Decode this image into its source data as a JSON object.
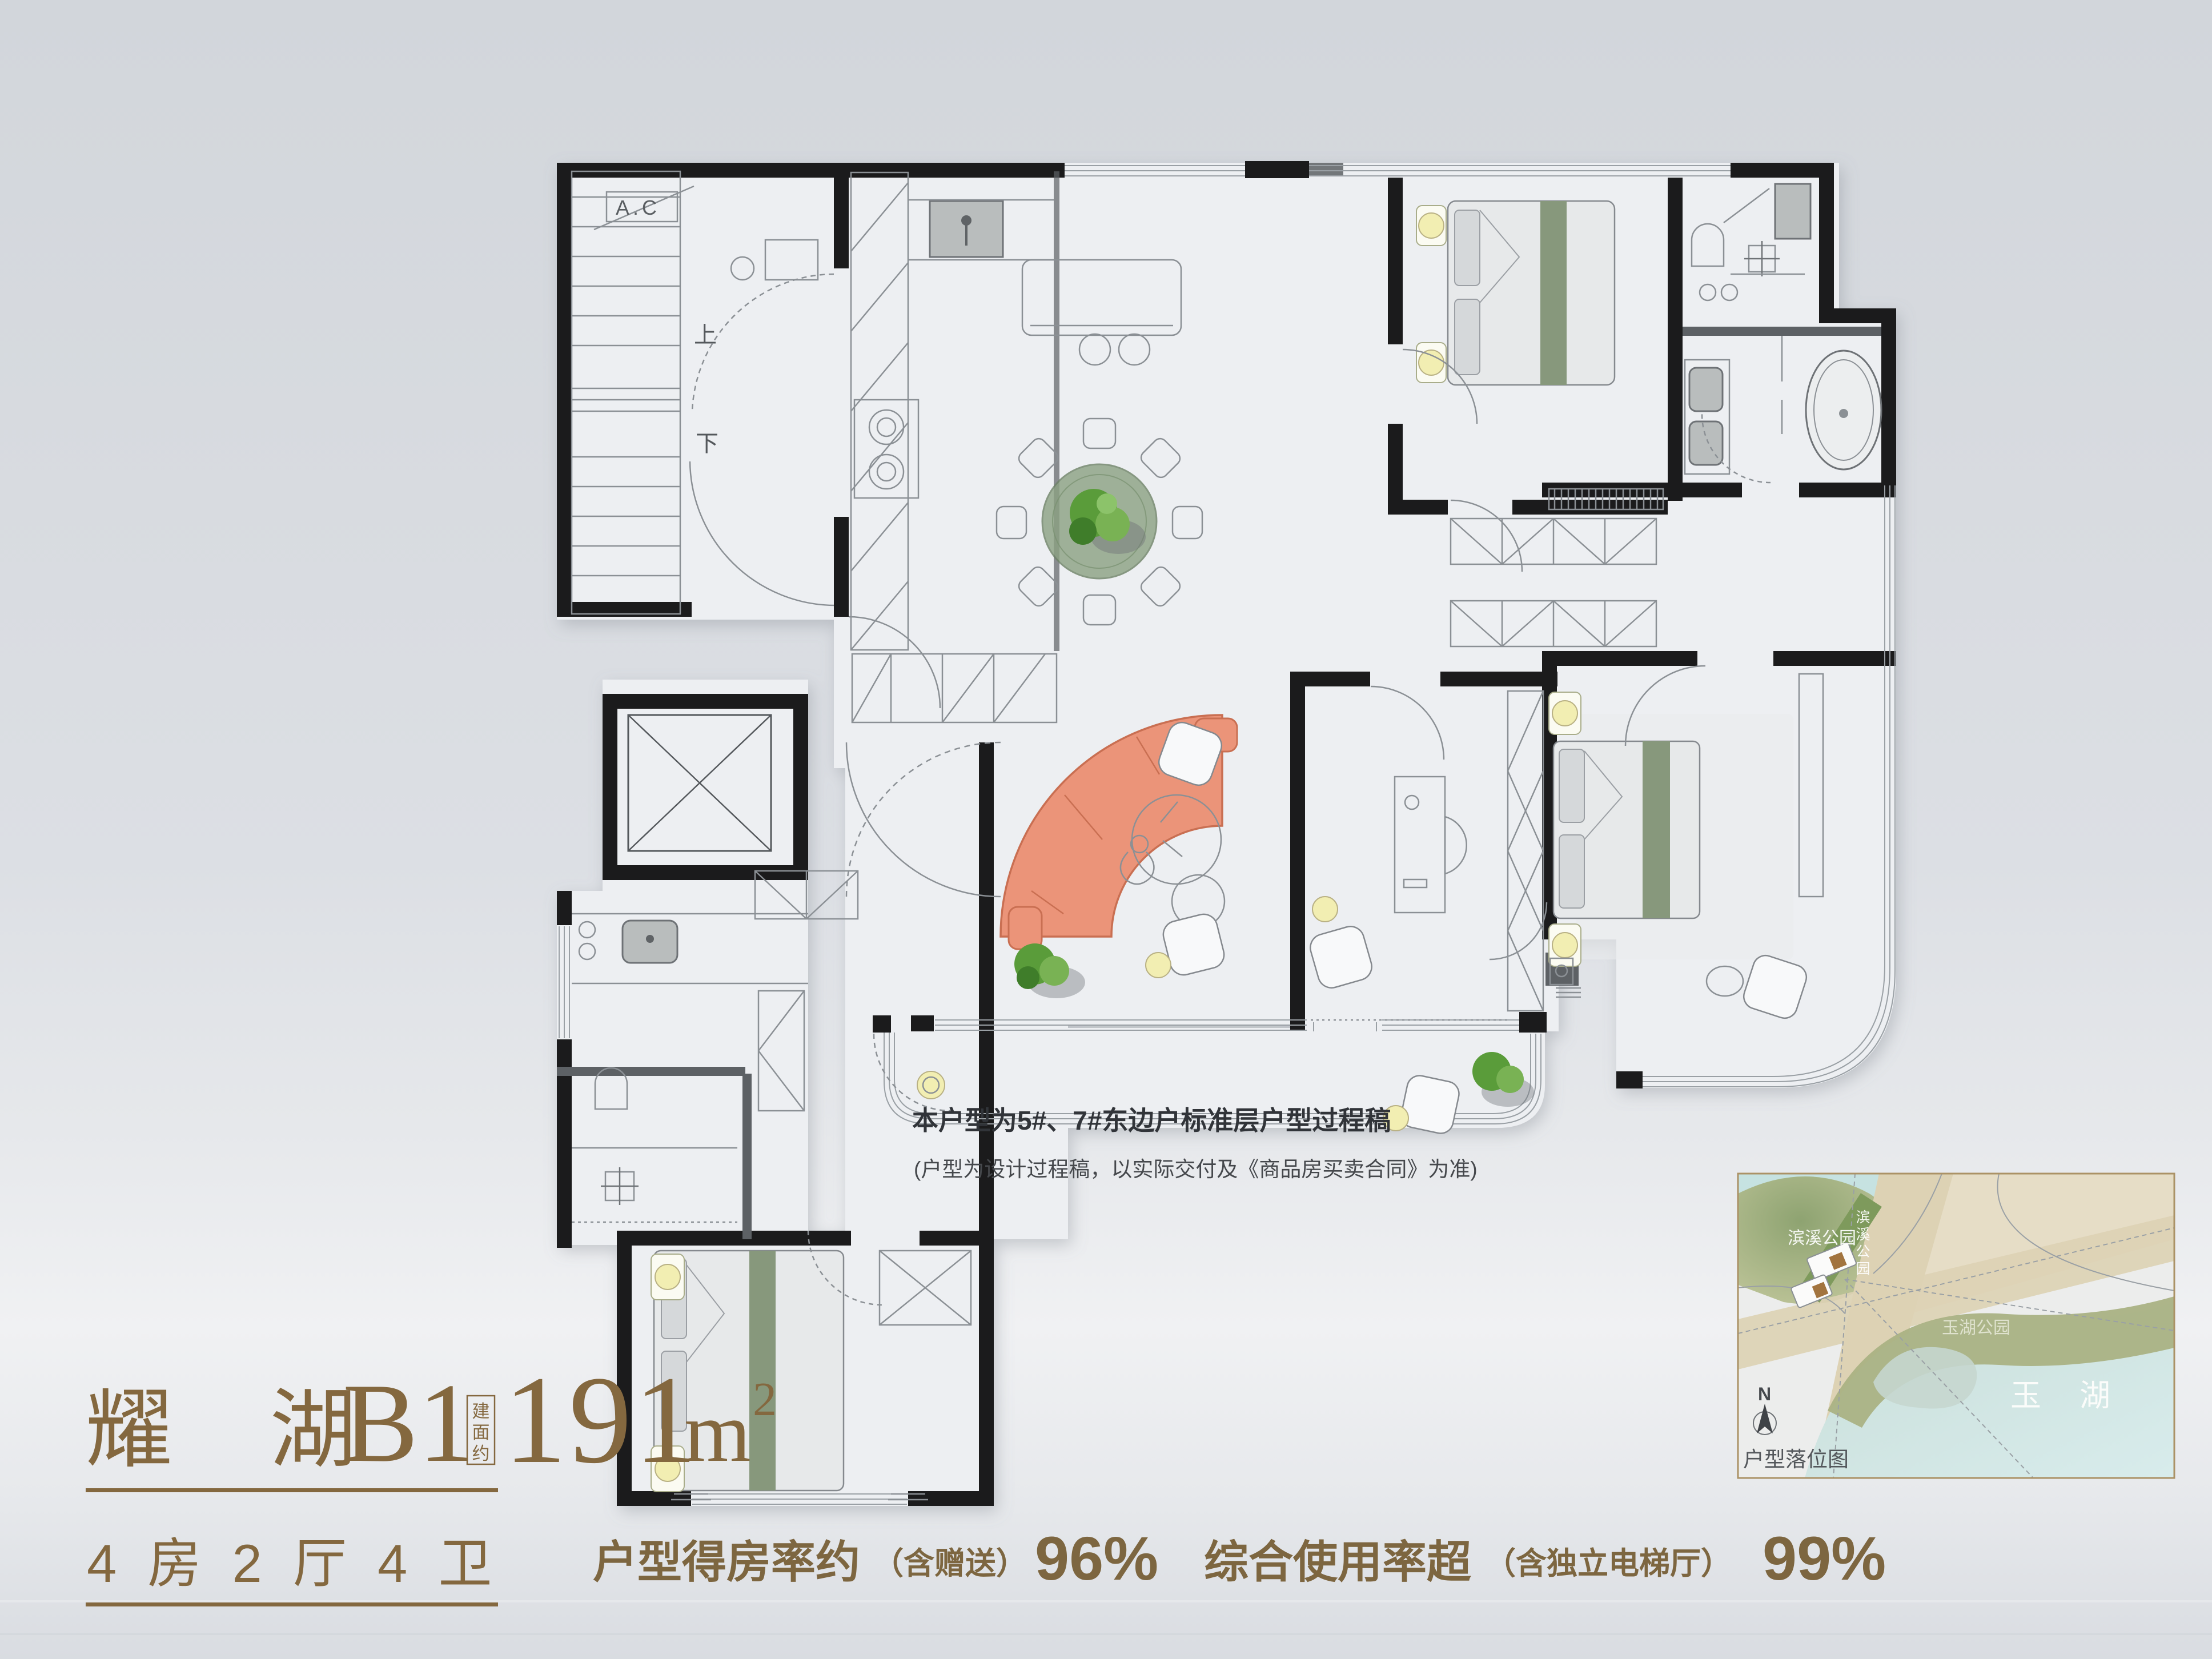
{
  "title": {
    "project": "耀 湖",
    "unit": "B1",
    "area_label_vertical": "建面约",
    "area_value": "191",
    "area_unit": "m",
    "area_sup": "2",
    "specs": "4 房 2 厅 4 卫"
  },
  "stats": {
    "part1_label": "户型得房率约",
    "part1_paren": "（含赠送）",
    "part1_value": "96%",
    "part2_label": "综合使用率超",
    "part2_paren": "（含独立电梯厅）",
    "part2_value": "99%"
  },
  "note": {
    "line1": "本户型为5#、7#东边户标准层户型过程稿",
    "line2": "(户型为设计过程稿，以实际交付及《商品房买卖合同》为准)"
  },
  "plan": {
    "up": "上",
    "down": "下",
    "ac": "A.C"
  },
  "map": {
    "park1": "滨溪公园",
    "park1_vertical": "滨溪公园",
    "park2": "玉湖公园",
    "lake": "玉 湖",
    "compass": "N",
    "caption": "户型落位图"
  },
  "colors": {
    "brand_brown": "#84683f",
    "wall_black": "#1b1b1c",
    "sofa_salmon": "#eb9479",
    "bed_green": "#87987c",
    "glow_yellow": "#f2eeb2",
    "map_border_gold": "#ab9266",
    "lake_blue": "#cfe3e0",
    "park_olive": "#a9b284"
  }
}
